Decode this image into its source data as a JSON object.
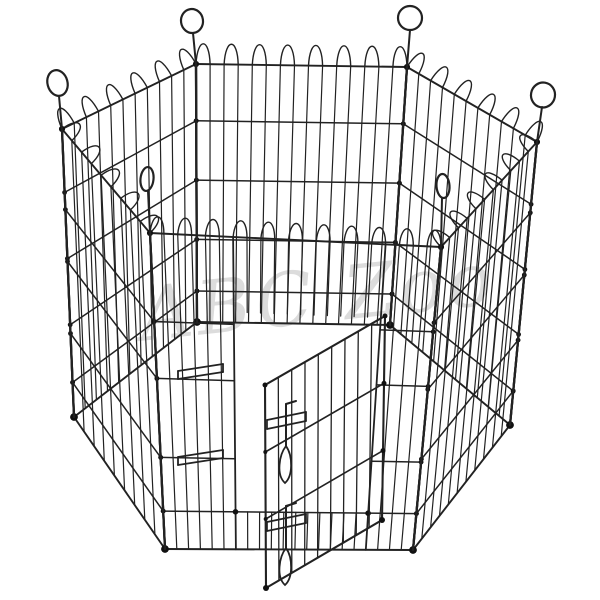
{
  "scene": {
    "background_color": "#ffffff",
    "wire_color": "#222222",
    "joint_dot_color": "#111111",
    "parts": {
      "panel_count": 6,
      "panels": [
        "back-left",
        "back-center",
        "back-right",
        "front-right",
        "front-left",
        "front-center"
      ],
      "door": "open-wire-door",
      "latches": [
        "top-slide-bolt-latch",
        "bottom-slide-bolt-latch"
      ],
      "corner_rings": 6
    }
  },
  "watermark": {
    "text": "ABC Zoo",
    "color": "#8f8f8f"
  }
}
